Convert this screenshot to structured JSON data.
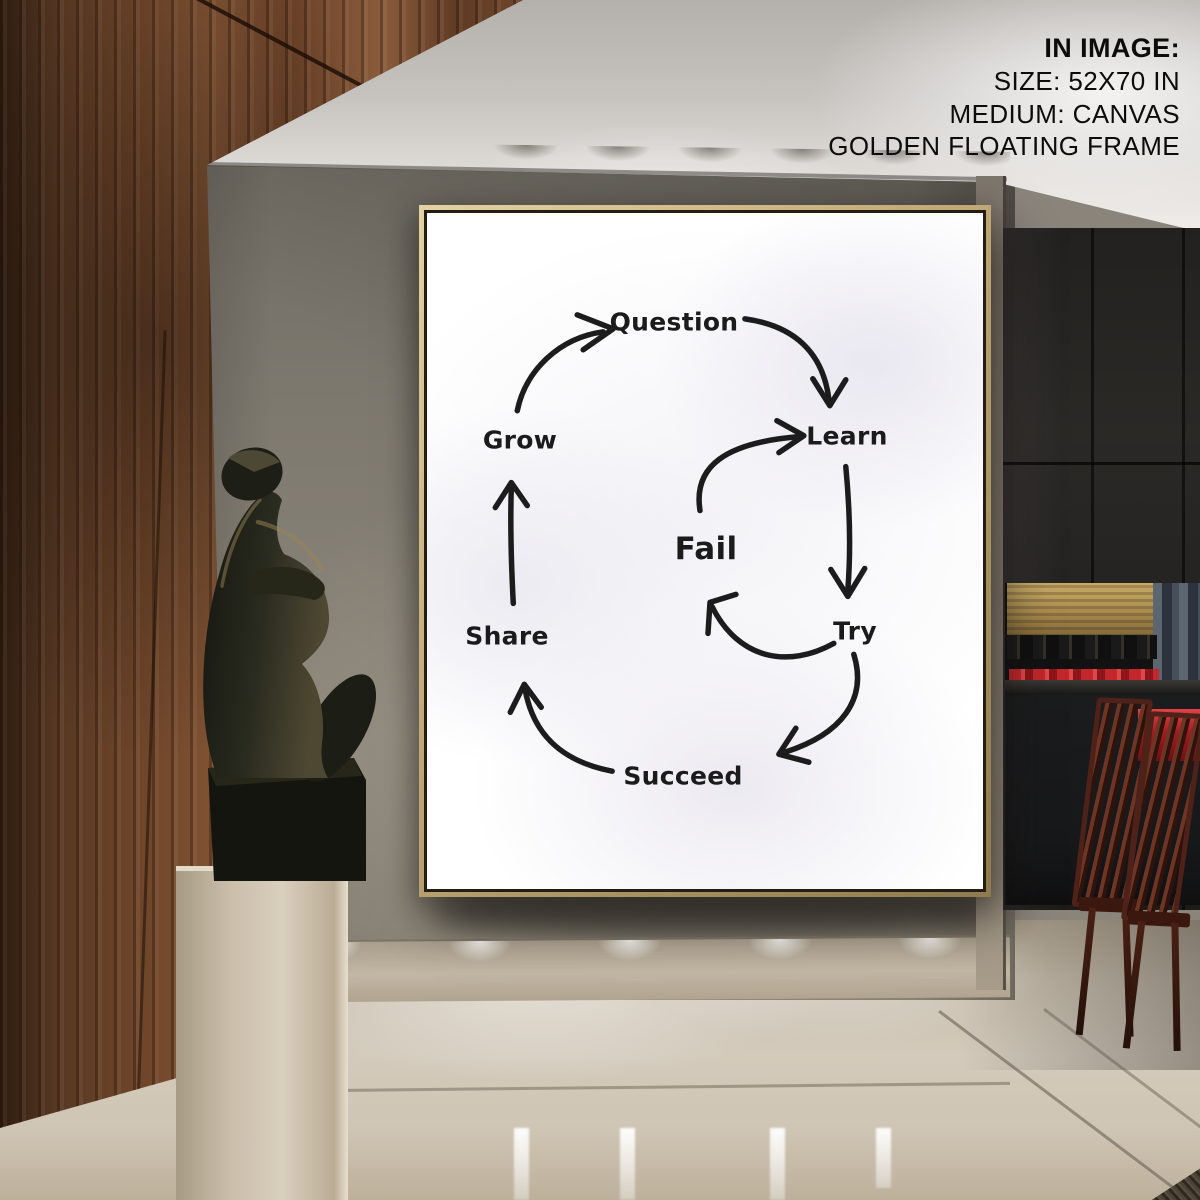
{
  "annotation": {
    "title": "IN IMAGE:",
    "lines": [
      "SIZE: 52X70 IN",
      "MEDIUM: CANVAS",
      "GOLDEN FLOATING FRAME"
    ]
  },
  "poster": {
    "type": "cycle-diagram",
    "nodes": [
      {
        "id": "question",
        "label": "Question"
      },
      {
        "id": "learn",
        "label": "Learn"
      },
      {
        "id": "try",
        "label": "Try"
      },
      {
        "id": "succeed",
        "label": "Succeed"
      },
      {
        "id": "share",
        "label": "Share"
      },
      {
        "id": "grow",
        "label": "Grow"
      }
    ],
    "center_node": {
      "id": "fail",
      "label": "Fail"
    },
    "edges": [
      {
        "from": "grow",
        "to": "question"
      },
      {
        "from": "question",
        "to": "learn"
      },
      {
        "from": "learn",
        "to": "try"
      },
      {
        "from": "try",
        "to": "succeed"
      },
      {
        "from": "succeed",
        "to": "share"
      },
      {
        "from": "share",
        "to": "grow"
      },
      {
        "from": "fail",
        "to": "learn"
      },
      {
        "from": "try",
        "to": "fail"
      }
    ],
    "ink_color": "#1c1c1c",
    "canvas_color": "#ffffff",
    "frame_color": "#c3ab79"
  },
  "scene": {
    "wood_wall_color": "#7f5233",
    "wall_color": "#8a847b",
    "ceiling_color": "#d9d6d2",
    "pedestal_color": "#cfc3b0",
    "sculpture_color": "#2c2d24",
    "chair_color": "#6e3424",
    "accent_red": "#c1272c",
    "backlight_gold": "#c9ab67",
    "floor_color": "#cfc5b4"
  }
}
